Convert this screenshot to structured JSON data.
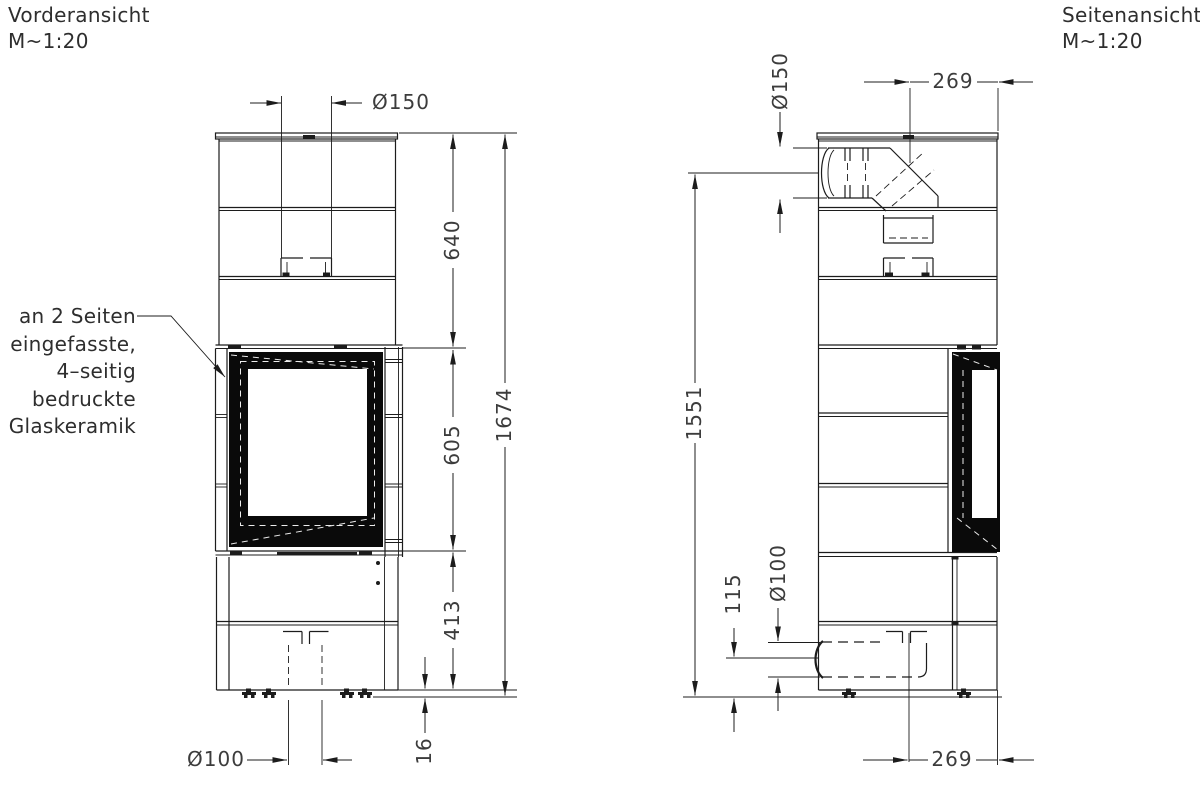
{
  "views": {
    "front": {
      "title": "Vorderansicht",
      "scale": "M~1:20",
      "dims": {
        "flue_diameter": "Ø150",
        "top_to_window": "640",
        "window_height": "605",
        "base_height": "413",
        "total_height": "1674",
        "air_inlet_diameter": "Ø100",
        "foot_height": "16"
      }
    },
    "side": {
      "title": "Seitenansicht",
      "scale": "M~1:20",
      "dims": {
        "flue_diameter": "Ø150",
        "flue_axis_to_front": "269",
        "flue_axis_to_floor": "1551",
        "inlet_axis_to_floor": "115",
        "air_inlet_diameter": "Ø100",
        "inlet_axis_to_front": "269"
      }
    }
  },
  "annotation": {
    "lines": [
      "an 2 Seiten",
      "eingefasste,",
      "4–seitig",
      "bedruckte",
      "Glaskeramik"
    ]
  },
  "colors": {
    "background": "#ffffff",
    "line": "#1c1c1c",
    "text": "#3c3c3c",
    "frame": "#0a0a0a"
  }
}
